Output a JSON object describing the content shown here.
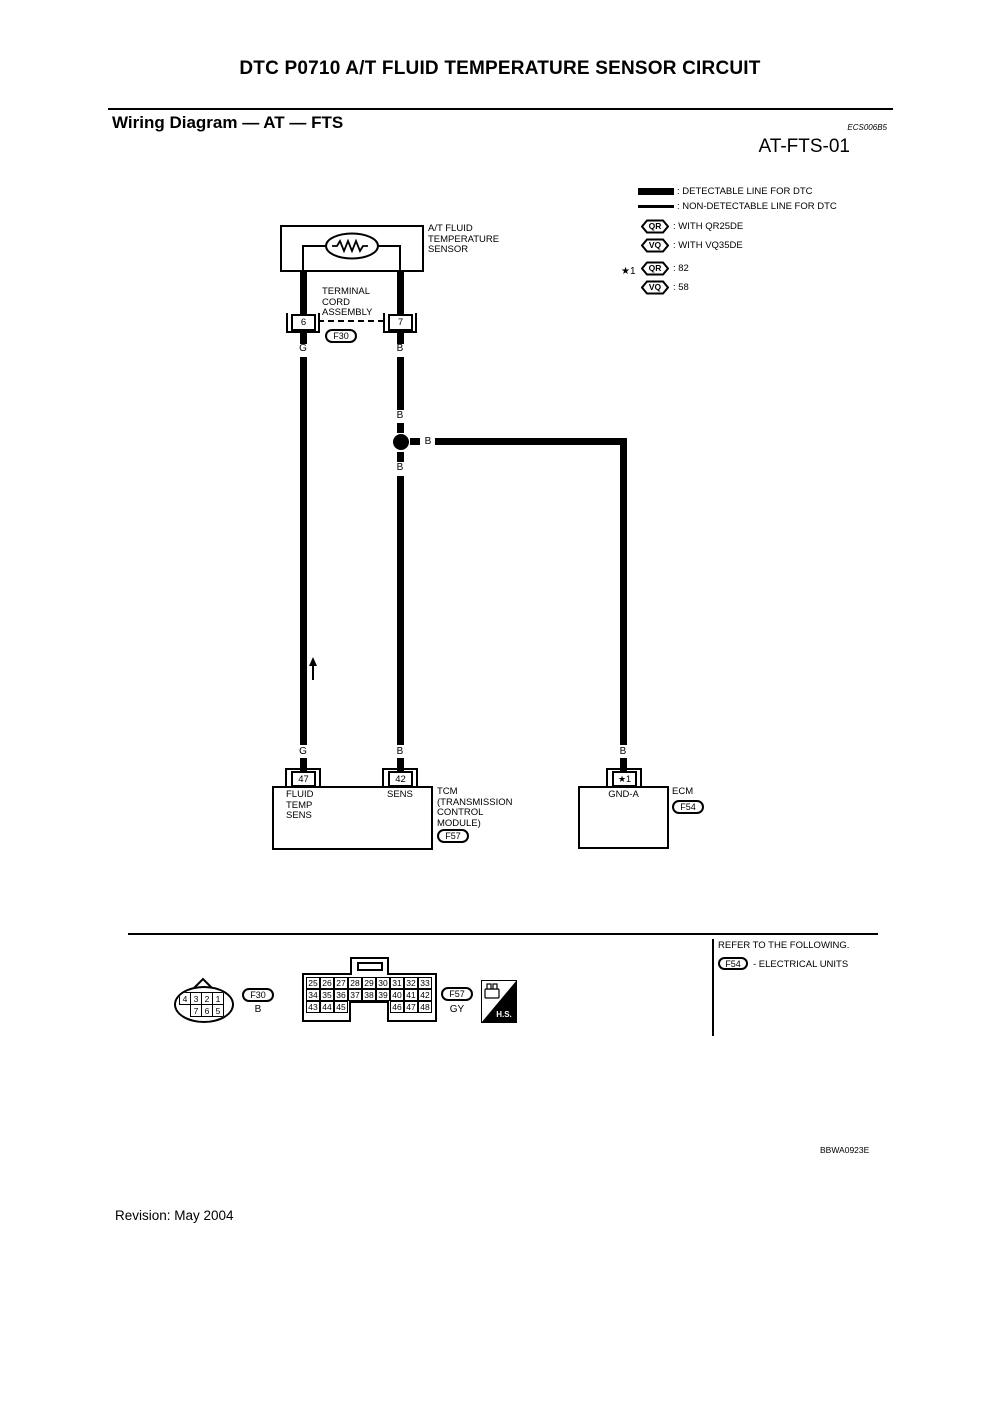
{
  "header": {
    "title": "DTC P0710 A/T FLUID TEMPERATURE SENSOR CIRCUIT",
    "section_title": "Wiring Diagram — AT — FTS",
    "section_code": "ECS006B5",
    "diagram_id": "AT-FTS-01"
  },
  "legend": {
    "detectable": ": DETECTABLE LINE FOR DTC",
    "non_detectable": ": NON-DETECTABLE LINE FOR DTC",
    "qr": "QR",
    "vq": "VQ",
    "with_qr": ": WITH QR25DE",
    "with_vq": ": WITH VQ35DE",
    "star_ref": "★1",
    "qr_value": ": 82",
    "vq_value": ": 58"
  },
  "sensor": {
    "label": [
      "A/T FLUID",
      "TEMPERATURE",
      "SENSOR"
    ],
    "assembly_label": [
      "TERMINAL",
      "CORD",
      "ASSEMBLY"
    ],
    "terminal_left": "6",
    "terminal_right": "7",
    "connector_ref": "F30"
  },
  "wire_labels": {
    "g_top": "G",
    "b_top": "B",
    "b_above_junction": "B",
    "b_branch": "B",
    "b_below_junction": "B",
    "g_bottom": "G",
    "b_bottom_mid": "B",
    "b_bottom_right": "B"
  },
  "tcm": {
    "terminal_left": "47",
    "terminal_right": "42",
    "pin_left_label": [
      "FLUID",
      "TEMP",
      "SENS"
    ],
    "pin_right_label": "SENS",
    "name": [
      "TCM",
      "(TRANSMISSION",
      "CONTROL",
      "MODULE)"
    ],
    "connector_ref": "F57"
  },
  "ecm": {
    "terminal": "★1",
    "pin_label": "GND-A",
    "name": "ECM",
    "connector_ref": "F54"
  },
  "connector_f30": {
    "ref": "F30",
    "color": "B",
    "row1": [
      "4",
      "3",
      "2",
      "1"
    ],
    "row2": [
      "7",
      "6",
      "5"
    ]
  },
  "connector_f57": {
    "ref": "F57",
    "color": "GY",
    "row1": [
      "25",
      "26",
      "27",
      "28",
      "29",
      "30",
      "31",
      "32",
      "33"
    ],
    "row2": [
      "34",
      "35",
      "36",
      "37",
      "38",
      "39",
      "40",
      "41",
      "42"
    ],
    "row3_left": [
      "43",
      "44",
      "45"
    ],
    "row3_right": [
      "46",
      "47",
      "48"
    ]
  },
  "hs": {
    "label": "H.S."
  },
  "refer": {
    "line1": "REFER TO THE FOLLOWING.",
    "ref": "F54",
    "text": "- ELECTRICAL UNITS"
  },
  "footer": {
    "figure_code": "BBWA0923E",
    "revision": "Revision: May 2004"
  }
}
